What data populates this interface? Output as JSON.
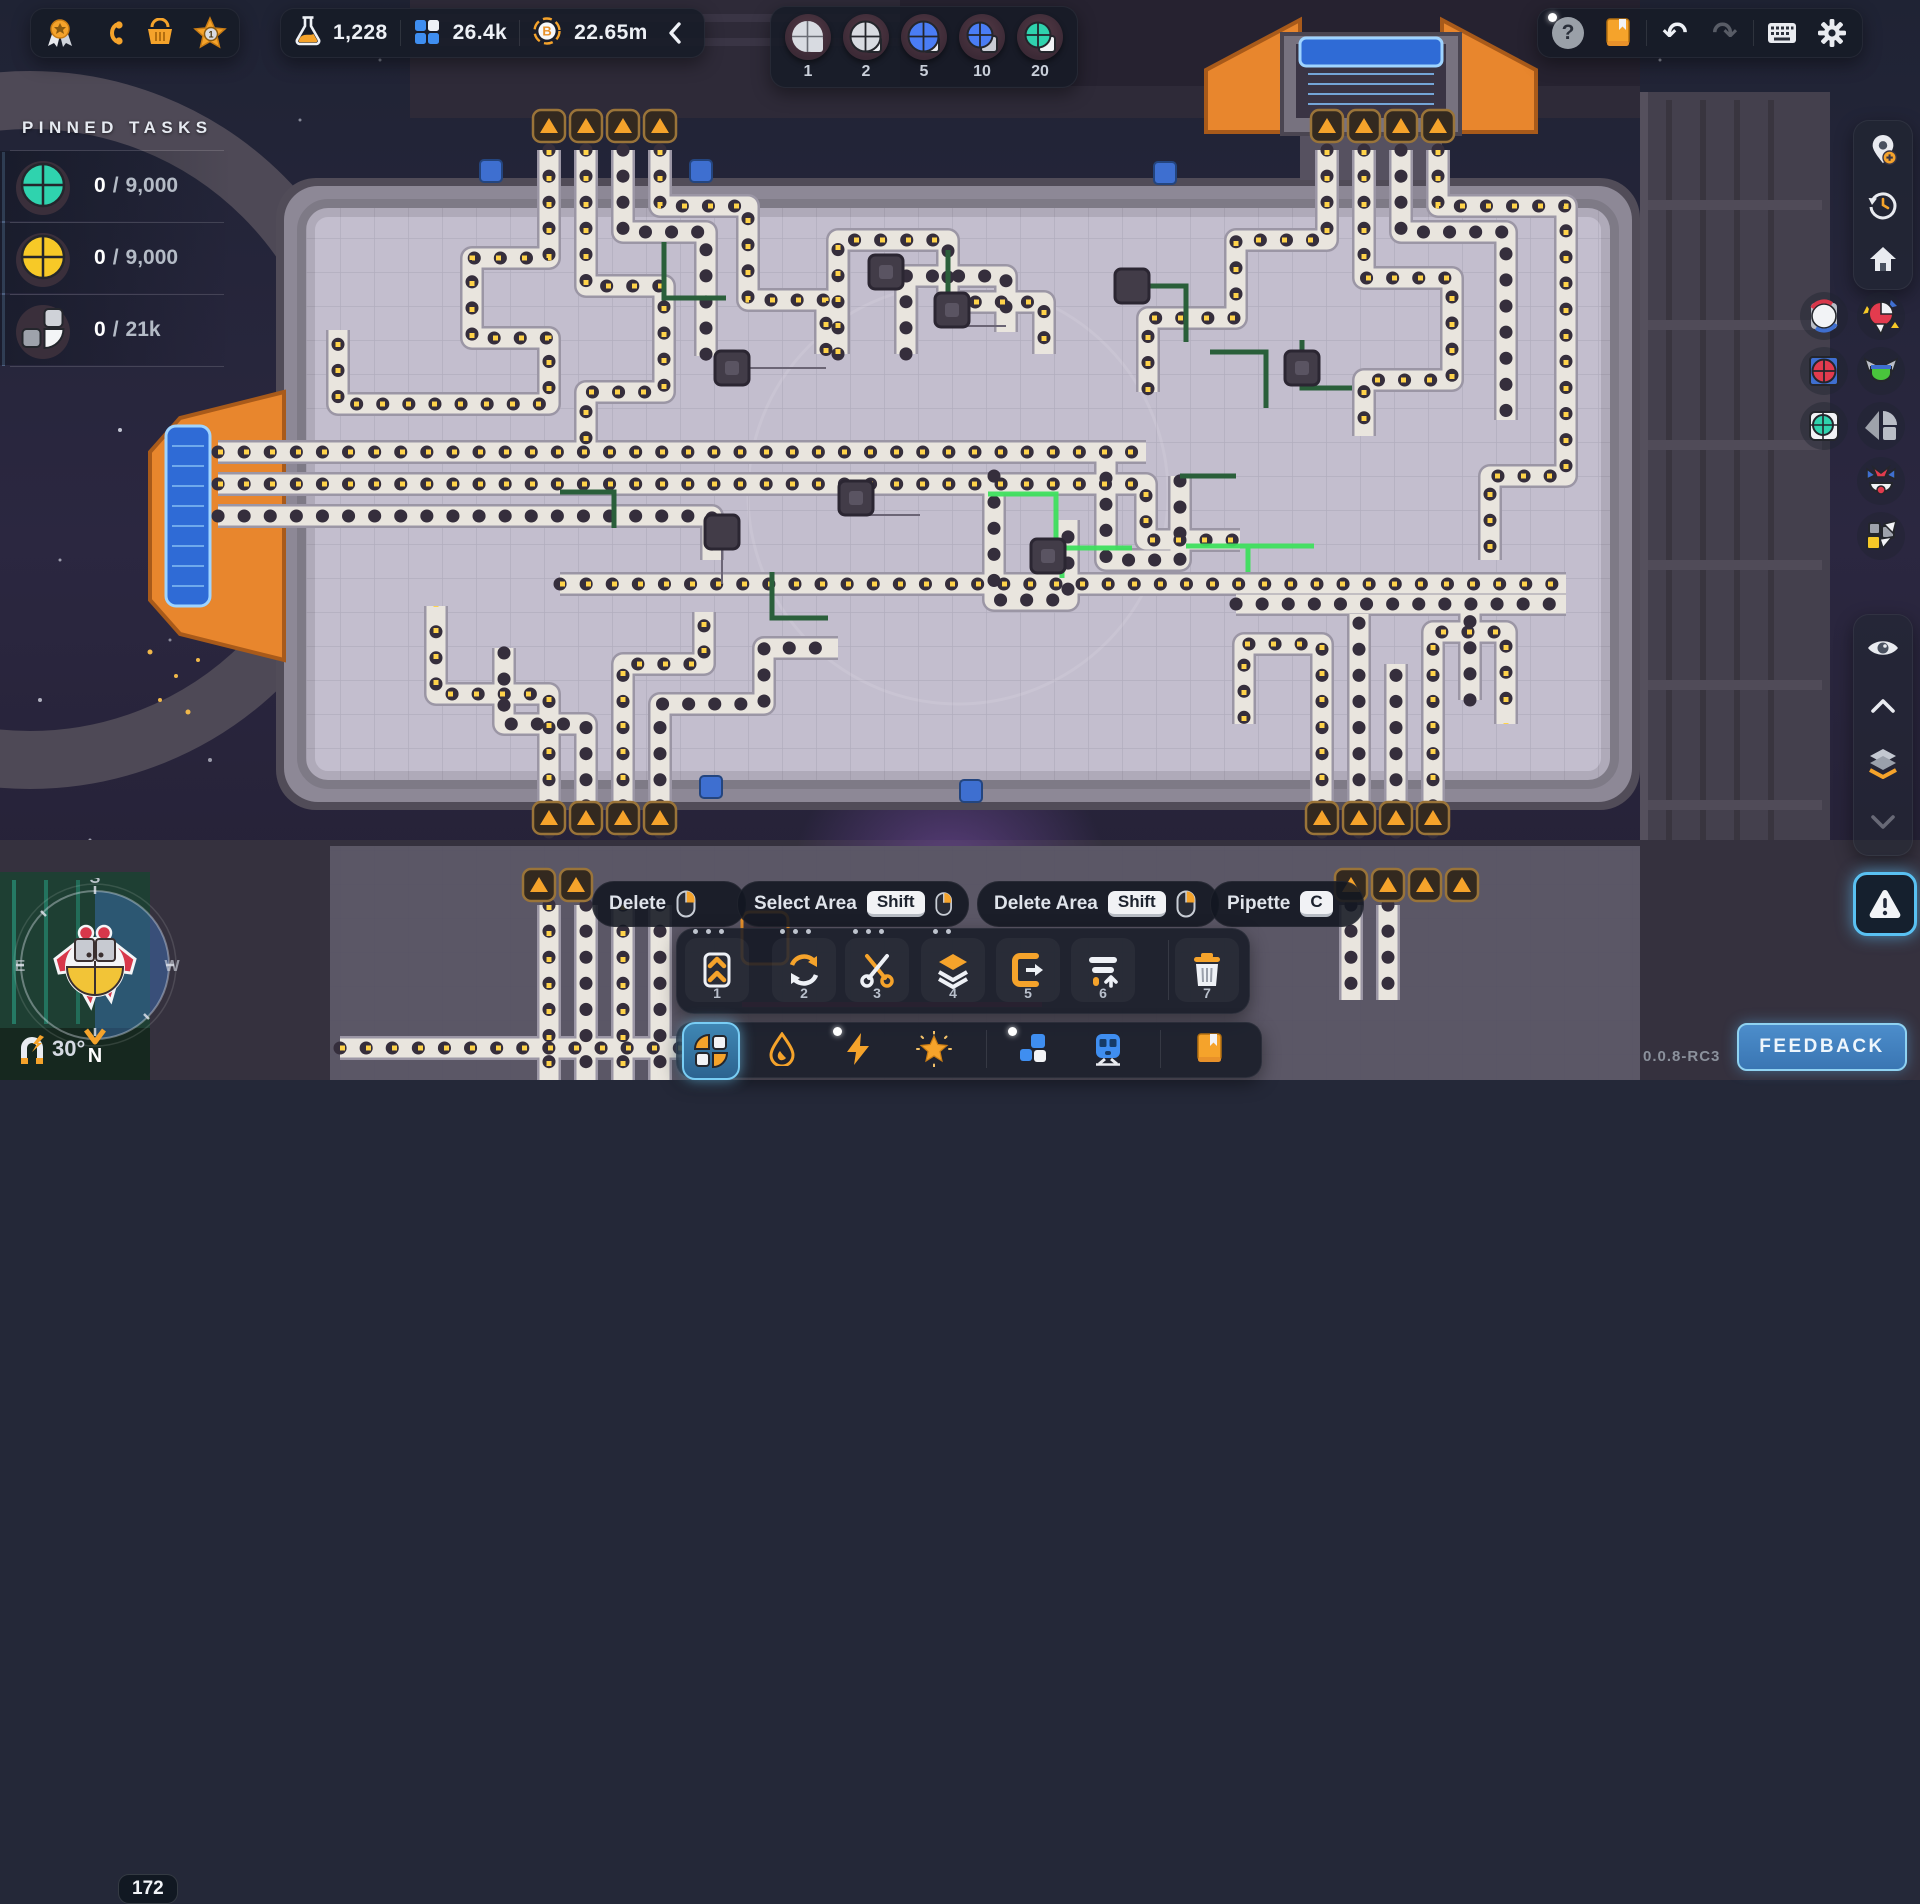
{
  "colors": {
    "accent_orange": "#f5a32b",
    "accent_blue": "#4a7df5",
    "teal": "#2fd3ae",
    "yellow": "#ffce44",
    "selected_glow": "#79cdf4",
    "feedback_blue": "#3d7cc0"
  },
  "topbar": {
    "nav": [
      {
        "icon": "medal-icon"
      },
      {
        "icon": "milestones-icon"
      },
      {
        "icon": "shop-icon"
      },
      {
        "icon": "level-star-icon",
        "badge": "1"
      }
    ],
    "resources": [
      {
        "icon": "research-flask-icon",
        "value": "1,228"
      },
      {
        "icon": "blueprint-points-icon",
        "value": "26.4k"
      },
      {
        "icon": "coin-icon",
        "value": "22.65m"
      }
    ],
    "collapse": {
      "icon": "chevron-left-icon"
    },
    "shape_slots": [
      {
        "count": "1",
        "shape": "gray-circle"
      },
      {
        "count": "2",
        "shape": "gray-circle-outlined"
      },
      {
        "count": "5",
        "shape": "blue-circle"
      },
      {
        "count": "10",
        "shape": "blue-circle-small"
      },
      {
        "count": "20",
        "shape": "teal-circle"
      }
    ],
    "system": {
      "help": {
        "icon": "help-icon",
        "label": "?",
        "notification": true
      },
      "guide": {
        "icon": "book-icon"
      },
      "undo": {
        "icon": "undo-icon",
        "glyph": "↶",
        "enabled": true
      },
      "redo": {
        "icon": "redo-icon",
        "glyph": "↷",
        "enabled": false
      },
      "keys": {
        "icon": "keyboard-icon"
      },
      "settings": {
        "icon": "gear-icon"
      }
    }
  },
  "pinned_tasks": {
    "title": "PINNED TASKS",
    "separator": "/",
    "tasks": [
      {
        "shape": "teal-circle-shape",
        "current": "0",
        "goal": "9,000"
      },
      {
        "shape": "yellow-circle-shape",
        "current": "0",
        "goal": "9,000"
      },
      {
        "shape": "gray-quad-shape",
        "current": "0",
        "goal": "21k"
      }
    ]
  },
  "right_toolbar": {
    "top": [
      {
        "icon": "add-waypoint-icon"
      },
      {
        "icon": "history-icon"
      },
      {
        "icon": "home-icon"
      }
    ],
    "waypoints_col1": [
      {
        "icon": "white-circle-swirl-shape-icon"
      },
      {
        "icon": "red-circle-blue-square-shape-icon"
      },
      {
        "icon": "teal-circle-white-square-shape-icon"
      }
    ],
    "waypoints_col2": [
      {
        "icon": "red-pinwheel-shape-icon"
      },
      {
        "icon": "green-blue-v-shape-icon"
      },
      {
        "icon": "gray-windmill-shape-icon"
      },
      {
        "icon": "red-blue-crab-shape-icon"
      },
      {
        "icon": "yellow-gray-squares-shape-icon"
      }
    ],
    "bottom": [
      {
        "icon": "visibility-eye-icon"
      },
      {
        "icon": "layer-up-icon"
      },
      {
        "icon": "layers-icon"
      },
      {
        "icon": "layer-down-icon"
      }
    ],
    "alert": {
      "icon": "warning-icon"
    }
  },
  "hint_bar": {
    "hints": [
      {
        "label": "Delete",
        "mouse": "right"
      },
      {
        "label": "Select Area",
        "key": "Shift",
        "mouse": "right"
      },
      {
        "label": "Delete Area",
        "key": "Shift",
        "mouse": "right"
      },
      {
        "label": "Pipette",
        "key": "C"
      }
    ]
  },
  "toolbar": {
    "tools": [
      {
        "hotkey": "1",
        "icon": "belt-planner-icon",
        "pins": 3
      },
      {
        "hotkey": "2",
        "icon": "rotate-icon",
        "pins": 3
      },
      {
        "hotkey": "3",
        "icon": "cut-icon",
        "pins": 3
      },
      {
        "hotkey": "4",
        "icon": "copy-stack-icon",
        "pins": 2
      },
      {
        "hotkey": "5",
        "icon": "paste-icon",
        "pins": 0
      },
      {
        "hotkey": "6",
        "icon": "lift-icon",
        "pins": 0
      },
      {
        "hotkey": "7",
        "icon": "trash-icon",
        "pins": 0
      }
    ],
    "categories": [
      {
        "icon": "shapes-category-icon",
        "selected": true
      },
      {
        "icon": "fluids-category-icon",
        "selected": false
      },
      {
        "icon": "electricity-category-icon",
        "selected": false,
        "notification": true
      },
      {
        "icon": "effects-category-icon",
        "selected": false
      },
      {
        "icon": "platforms-category-icon",
        "selected": false,
        "notification": true
      },
      {
        "icon": "trains-category-icon",
        "selected": false
      },
      {
        "icon": "wiki-category-icon",
        "selected": false
      }
    ]
  },
  "compass": {
    "north": "N",
    "south": "S",
    "east": "E",
    "west": "W",
    "rotation": "30°",
    "badge": "172"
  },
  "footer": {
    "version": "0.0.8-RC3",
    "feedback_label": "FEEDBACK"
  }
}
